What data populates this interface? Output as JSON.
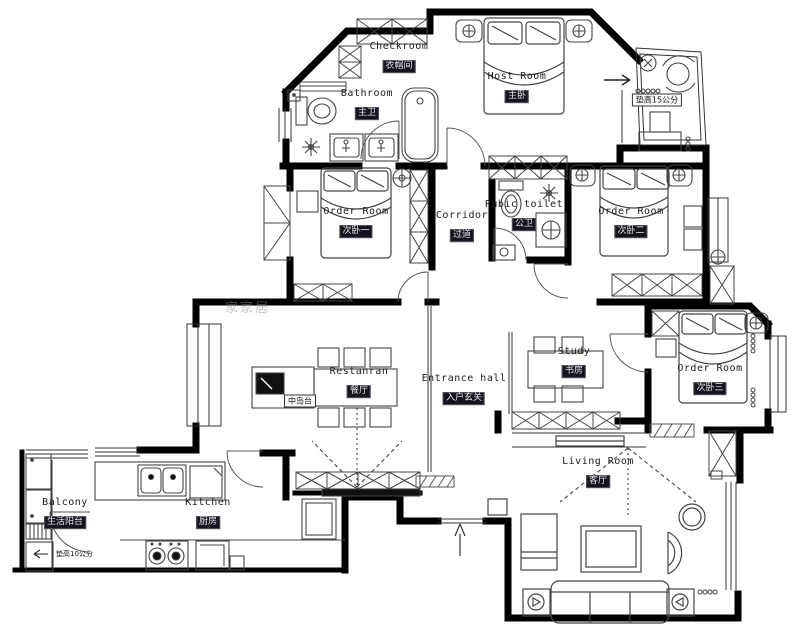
{
  "plan": {
    "watermark": "家家居",
    "rooms": [
      {
        "id": "checkroom",
        "en": "Checkroom",
        "cn": "衣帽间"
      },
      {
        "id": "bathroom",
        "en": "Bathroom",
        "cn": "主卫"
      },
      {
        "id": "host-room",
        "en": "Host Room",
        "cn": "主卧"
      },
      {
        "id": "order-room-1",
        "en": "Order Room",
        "cn": "次卧一"
      },
      {
        "id": "corridor",
        "en": "Corridor",
        "cn": "过道"
      },
      {
        "id": "public-toilet",
        "en": "Pubic toilet",
        "cn": "公卫"
      },
      {
        "id": "order-room-2",
        "en": "Order Room",
        "cn": "次卧二"
      },
      {
        "id": "restaurant",
        "en": "Restanran",
        "cn": "餐厅"
      },
      {
        "id": "entrance-hall",
        "en": "Entrance hall",
        "cn": "入户玄关"
      },
      {
        "id": "study",
        "en": "Study",
        "cn": "书房"
      },
      {
        "id": "order-room-3",
        "en": "Order Room",
        "cn": "次卧三"
      },
      {
        "id": "living-room",
        "en": "Living Room",
        "cn": "客厅"
      },
      {
        "id": "kitchen",
        "en": "Kitchen",
        "cn": "厨房"
      },
      {
        "id": "balcony",
        "en": "Balcony",
        "cn": "生活阳台"
      }
    ],
    "annotations": {
      "raise15": "垫高15公分",
      "raise10": "垫高10公分",
      "island": "中岛台"
    }
  }
}
